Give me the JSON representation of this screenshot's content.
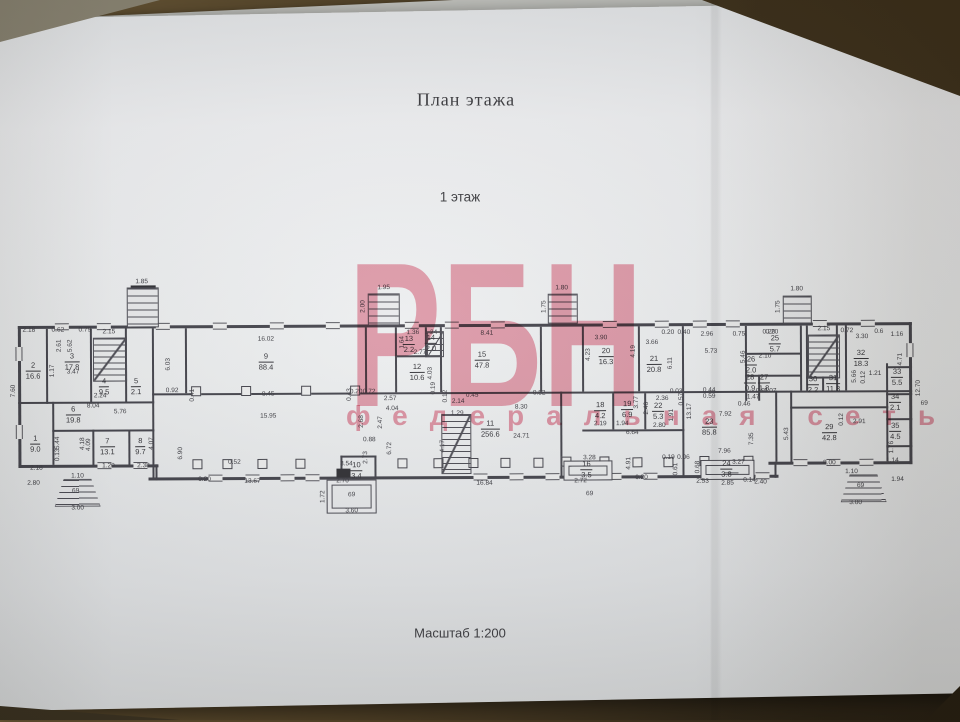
{
  "document": {
    "title": "План этажа",
    "subtitle": "1 этаж",
    "scale_label": "Масштаб 1:200"
  },
  "watermark": {
    "line1": "РБН",
    "line2": "федеральная сеть",
    "color": "#e05672"
  },
  "plan": {
    "rooms": [
      [
        "1",
        "9.0",
        35,
        442
      ],
      [
        "2",
        "16.6",
        33,
        369
      ],
      [
        "3",
        "17.8",
        72,
        360
      ],
      [
        "4",
        "9.5",
        104,
        385
      ],
      [
        "5",
        "2.1",
        136,
        385
      ],
      [
        "6",
        "19.8",
        73,
        413
      ],
      [
        "7",
        "13.1",
        107,
        445
      ],
      [
        "8",
        "9.7",
        140,
        445
      ],
      [
        "9",
        "88.4",
        266,
        361
      ],
      [
        "10",
        "3.4",
        356,
        470
      ],
      [
        "11",
        "256.6",
        490,
        429
      ],
      [
        "12",
        "10.6",
        417,
        372
      ],
      [
        "13",
        "2.2",
        409,
        344
      ],
      [
        "14",
        "2.0",
        431,
        343
      ],
      [
        "15",
        "47.8",
        482,
        360
      ],
      [
        "16",
        "3.5",
        586,
        470
      ],
      [
        "18",
        "4.2",
        600,
        411
      ],
      [
        "19",
        "6.9",
        627,
        410
      ],
      [
        "20",
        "16.3",
        606,
        357
      ],
      [
        "21",
        "20.8",
        654,
        365
      ],
      [
        "22",
        "5.3",
        658,
        412
      ],
      [
        "23",
        "85.8",
        709,
        428
      ],
      [
        "24",
        "3.8",
        726,
        470
      ],
      [
        "25",
        "5.7",
        775,
        345
      ],
      [
        "26",
        "2.0",
        751,
        366
      ],
      [
        "27",
        "1.8",
        764,
        384
      ],
      [
        "28",
        "0.9",
        750,
        384
      ],
      [
        "29",
        "42.8",
        829,
        434
      ],
      [
        "30",
        "2.2",
        813,
        386
      ],
      [
        "31",
        "11.8",
        833,
        385
      ],
      [
        "32",
        "18.3",
        861,
        360
      ],
      [
        "33",
        "5.5",
        897,
        379
      ],
      [
        "34",
        "2.1",
        895,
        404
      ],
      [
        "35",
        "4.5",
        895,
        433
      ]
    ],
    "dims": [
      [
        "2.18",
        29,
        329,
        0
      ],
      [
        "0.62",
        58,
        329,
        0
      ],
      [
        "0.79",
        85,
        329,
        0
      ],
      [
        "2.15",
        109,
        331,
        0
      ],
      [
        "1.85",
        142,
        281,
        0
      ],
      [
        "16.02",
        266,
        339,
        0
      ],
      [
        "1.95",
        384,
        288,
        0
      ],
      [
        "2.00",
        364,
        306,
        1
      ],
      [
        "8.41",
        487,
        334,
        0
      ],
      [
        "1.80",
        562,
        289,
        0
      ],
      [
        "1.75",
        545,
        307,
        1
      ],
      [
        "3.90",
        601,
        339,
        0
      ],
      [
        "0.20",
        668,
        334,
        0
      ],
      [
        "0.40",
        684,
        334,
        0
      ],
      [
        "3.66",
        652,
        344,
        0
      ],
      [
        "2.96",
        707,
        336,
        0
      ],
      [
        "0.75",
        739,
        336,
        0
      ],
      [
        "0.20",
        769,
        334,
        0
      ],
      [
        "2.15",
        824,
        331,
        0
      ],
      [
        "0.72",
        847,
        333,
        0
      ],
      [
        "3.30",
        862,
        339,
        0
      ],
      [
        "0.6",
        879,
        334,
        0
      ],
      [
        "1.16",
        897,
        337,
        0
      ],
      [
        "1.80",
        797,
        291,
        0
      ],
      [
        "1.75",
        779,
        308,
        1
      ],
      [
        "5.62",
        71,
        344,
        1
      ],
      [
        "2.61",
        60,
        344,
        1
      ],
      [
        "1.17",
        53,
        369,
        1
      ],
      [
        "3.47",
        73,
        371,
        0
      ],
      [
        "7.60",
        14,
        389,
        1
      ],
      [
        "6.03",
        169,
        363,
        1
      ],
      [
        "0.92",
        172,
        390,
        0
      ],
      [
        "8.04",
        93,
        405,
        0
      ],
      [
        "5.76",
        120,
        411,
        0
      ],
      [
        "5.44",
        58,
        441,
        1
      ],
      [
        "4.18",
        83,
        442,
        1
      ],
      [
        "4.09",
        89,
        443,
        1
      ],
      [
        "4.07",
        152,
        442,
        1
      ],
      [
        "0.13",
        58,
        453,
        1
      ],
      [
        "1.20",
        108,
        465,
        0
      ],
      [
        "2.38",
        143,
        465,
        0
      ],
      [
        "2.18",
        36,
        467,
        0
      ],
      [
        "2.80",
        33,
        482,
        0
      ],
      [
        "6.90",
        181,
        452,
        1
      ],
      [
        "2.24",
        100,
        395,
        0
      ],
      [
        "0.41",
        193,
        394,
        1
      ],
      [
        "0.45",
        268,
        394,
        0
      ],
      [
        "0.43",
        350,
        394,
        1
      ],
      [
        "0.20",
        356,
        392,
        0
      ],
      [
        "0.72",
        369,
        392,
        0
      ],
      [
        "15.95",
        268,
        416,
        0
      ],
      [
        "0.52",
        234,
        462,
        0
      ],
      [
        "0.20",
        204,
        479,
        0
      ],
      [
        "13.67",
        252,
        481,
        0
      ],
      [
        "3.54",
        346,
        464,
        0
      ],
      [
        "2.70",
        342,
        481,
        0
      ],
      [
        "2.68",
        362,
        421,
        1
      ],
      [
        "2.47",
        381,
        422,
        1
      ],
      [
        "0.88",
        369,
        440,
        0
      ],
      [
        "2.73",
        366,
        457,
        1
      ],
      [
        "1.72",
        323,
        496,
        1
      ],
      [
        "3.60",
        351,
        511,
        0
      ],
      [
        "2.57",
        390,
        399,
        0
      ],
      [
        "4.04",
        392,
        409,
        0
      ],
      [
        "2.14",
        458,
        402,
        0
      ],
      [
        "0.12",
        446,
        396,
        1
      ],
      [
        "0.19",
        434,
        388,
        1
      ],
      [
        "0.45",
        472,
        396,
        0
      ],
      [
        "8.30",
        521,
        408,
        0
      ],
      [
        "0.82",
        539,
        394,
        0
      ],
      [
        "1.29",
        457,
        414,
        0
      ],
      [
        "4.17",
        443,
        446,
        1
      ],
      [
        "6.72",
        390,
        448,
        1
      ],
      [
        "16.84",
        484,
        484,
        0
      ],
      [
        "24.71",
        521,
        437,
        0
      ],
      [
        "2.77",
        420,
        353,
        0
      ],
      [
        "4.03",
        431,
        373,
        1
      ],
      [
        "1.64",
        403,
        342,
        1
      ],
      [
        "1.36",
        413,
        333,
        0
      ],
      [
        "1.24",
        431,
        333,
        0
      ],
      [
        "4.23",
        589,
        355,
        1
      ],
      [
        "4.19",
        634,
        352,
        1
      ],
      [
        "6.11",
        671,
        364,
        1
      ],
      [
        "5.73",
        711,
        353,
        0
      ],
      [
        "5.46",
        744,
        358,
        1
      ],
      [
        "13.17",
        690,
        412,
        1
      ],
      [
        "0.57",
        682,
        400,
        1
      ],
      [
        "2.36",
        662,
        400,
        0
      ],
      [
        "0.03",
        676,
        393,
        0
      ],
      [
        "0.44",
        709,
        392,
        0
      ],
      [
        "0.59",
        709,
        398,
        0
      ],
      [
        "2.19",
        600,
        425,
        0
      ],
      [
        "1.94",
        622,
        425,
        0
      ],
      [
        "2.80",
        659,
        427,
        0
      ],
      [
        "6.64",
        632,
        434,
        0
      ],
      [
        "1.91",
        672,
        416,
        1
      ],
      [
        "7.92",
        725,
        416,
        0
      ],
      [
        "7.96",
        724,
        453,
        0
      ],
      [
        "7.35",
        752,
        440,
        1
      ],
      [
        "4.91",
        629,
        464,
        1
      ],
      [
        "0.19",
        668,
        459,
        0
      ],
      [
        "0.06",
        683,
        459,
        0
      ],
      [
        "0.61",
        676,
        470,
        1
      ],
      [
        "0.68",
        698,
        468,
        1
      ],
      [
        "3.28",
        589,
        459,
        0
      ],
      [
        "2.72",
        580,
        482,
        0
      ],
      [
        "2.53",
        702,
        483,
        0
      ],
      [
        "0.20",
        641,
        479,
        0
      ],
      [
        "3.27",
        738,
        464,
        0
      ],
      [
        "2.85",
        727,
        485,
        0
      ],
      [
        "0.14",
        749,
        482,
        0
      ],
      [
        "2.40",
        760,
        484,
        0
      ],
      [
        "3.77",
        637,
        403,
        1
      ],
      [
        "2.46",
        647,
        409,
        1
      ],
      [
        "0.20",
        772,
        334,
        0
      ],
      [
        "2.10",
        765,
        358,
        0
      ],
      [
        "1.47",
        753,
        399,
        0
      ],
      [
        "0.91",
        762,
        393,
        0
      ],
      [
        "1.07",
        770,
        393,
        0
      ],
      [
        "0.46",
        744,
        406,
        0
      ],
      [
        "5.66",
        855,
        378,
        1
      ],
      [
        "0.12",
        864,
        379,
        1
      ],
      [
        "1.21",
        875,
        376,
        0
      ],
      [
        "4.71",
        901,
        361,
        1
      ],
      [
        "12.70",
        919,
        390,
        1
      ],
      [
        "2.91",
        859,
        424,
        0
      ],
      [
        "0.12",
        842,
        421,
        1
      ],
      [
        "5.43",
        787,
        435,
        1
      ],
      [
        "8.00",
        829,
        465,
        0
      ],
      [
        "1.76",
        892,
        449,
        1
      ],
      [
        "1.14",
        892,
        463,
        0
      ],
      [
        "1.94",
        897,
        482,
        0
      ],
      [
        "1.10",
        851,
        474,
        0
      ],
      [
        "3.00",
        855,
        505,
        0
      ],
      [
        "1.10",
        77,
        475,
        0
      ],
      [
        "3.00",
        77,
        507,
        0
      ],
      [
        "69",
        75,
        490,
        0
      ],
      [
        "69",
        351,
        495,
        0
      ],
      [
        "69",
        589,
        495,
        0
      ],
      [
        "69",
        860,
        488,
        0
      ],
      [
        "69",
        924,
        406,
        0
      ]
    ],
    "walls": [
      [
        18,
        324,
        894,
        3
      ],
      [
        18,
        324,
        3,
        142
      ],
      [
        909,
        324,
        3,
        142
      ],
      [
        18,
        463,
        140,
        3
      ],
      [
        768,
        463,
        144,
        3
      ],
      [
        148,
        476,
        630,
        3
      ],
      [
        155,
        463,
        2,
        16
      ],
      [
        774,
        463,
        2,
        16
      ],
      [
        46,
        327,
        2,
        75
      ],
      [
        90,
        327,
        2,
        75
      ],
      [
        125,
        327,
        2,
        75
      ],
      [
        152,
        327,
        2,
        150
      ],
      [
        185,
        327,
        2,
        65
      ],
      [
        18,
        400,
        136,
        2
      ],
      [
        52,
        400,
        2,
        63
      ],
      [
        52,
        428,
        102,
        2
      ],
      [
        92,
        428,
        2,
        36
      ],
      [
        128,
        428,
        2,
        36
      ],
      [
        152,
        392,
        760,
        2
      ],
      [
        365,
        327,
        2,
        65
      ],
      [
        395,
        327,
        2,
        65
      ],
      [
        425,
        327,
        2,
        30
      ],
      [
        440,
        327,
        2,
        65
      ],
      [
        395,
        355,
        47,
        2
      ],
      [
        540,
        327,
        2,
        65
      ],
      [
        560,
        392,
        2,
        86
      ],
      [
        340,
        455,
        36,
        2
      ],
      [
        340,
        455,
        2,
        22
      ],
      [
        374,
        455,
        2,
        22
      ],
      [
        582,
        327,
        2,
        65
      ],
      [
        638,
        327,
        2,
        65
      ],
      [
        682,
        327,
        2,
        65
      ],
      [
        582,
        430,
        102,
        2
      ],
      [
        612,
        394,
        2,
        36
      ],
      [
        644,
        394,
        2,
        36
      ],
      [
        682,
        392,
        2,
        85
      ],
      [
        745,
        327,
        2,
        75
      ],
      [
        800,
        327,
        2,
        65
      ],
      [
        745,
        354,
        56,
        2
      ],
      [
        745,
        376,
        56,
        2
      ],
      [
        758,
        376,
        2,
        26
      ],
      [
        775,
        392,
        2,
        71
      ],
      [
        790,
        392,
        2,
        73
      ],
      [
        790,
        408,
        98,
        2
      ],
      [
        806,
        327,
        2,
        65
      ],
      [
        836,
        327,
        2,
        65
      ],
      [
        806,
        378,
        32,
        2
      ],
      [
        822,
        378,
        2,
        14
      ],
      [
        845,
        327,
        2,
        65
      ],
      [
        886,
        365,
        2,
        98
      ],
      [
        886,
        368,
        26,
        2
      ],
      [
        886,
        395,
        26,
        2
      ],
      [
        886,
        420,
        26,
        2
      ],
      [
        886,
        447,
        26,
        2
      ]
    ],
    "windows": [
      [
        62,
        325,
        0
      ],
      [
        104,
        325,
        0
      ],
      [
        163,
        325,
        0
      ],
      [
        220,
        325,
        0
      ],
      [
        277,
        325,
        0
      ],
      [
        333,
        325,
        0
      ],
      [
        412,
        325,
        0
      ],
      [
        452,
        325,
        0
      ],
      [
        498,
        325,
        0
      ],
      [
        610,
        325,
        0
      ],
      [
        662,
        325,
        0
      ],
      [
        700,
        325,
        0
      ],
      [
        733,
        325,
        0
      ],
      [
        820,
        325,
        0
      ],
      [
        868,
        325,
        0
      ],
      [
        215,
        477,
        0
      ],
      [
        252,
        477,
        0
      ],
      [
        287,
        477,
        0
      ],
      [
        312,
        477,
        0
      ],
      [
        480,
        477,
        0
      ],
      [
        516,
        477,
        0
      ],
      [
        552,
        477,
        0
      ],
      [
        614,
        477,
        0
      ],
      [
        650,
        477,
        0
      ],
      [
        731,
        477,
        0
      ],
      [
        762,
        477,
        0
      ],
      [
        104,
        464,
        0
      ],
      [
        140,
        464,
        0
      ],
      [
        800,
        464,
        0
      ],
      [
        833,
        464,
        0
      ],
      [
        866,
        464,
        0
      ],
      [
        19,
        352,
        1
      ],
      [
        19,
        430,
        1
      ],
      [
        910,
        352,
        1
      ]
    ],
    "columns": [
      [
        197,
        463
      ],
      [
        227,
        463
      ],
      [
        262,
        463
      ],
      [
        300,
        463
      ],
      [
        402,
        463
      ],
      [
        438,
        463
      ],
      [
        473,
        463
      ],
      [
        505,
        463
      ],
      [
        538,
        463
      ],
      [
        637,
        463
      ],
      [
        668,
        463
      ],
      [
        196,
        390
      ],
      [
        246,
        390
      ],
      [
        306,
        390
      ],
      [
        355,
        390
      ],
      [
        566,
        462
      ],
      [
        604,
        462
      ],
      [
        704,
        462
      ],
      [
        748,
        462
      ]
    ],
    "stairs": [
      [
        93,
        336,
        32,
        42
      ],
      [
        441,
        414,
        28,
        58
      ],
      [
        808,
        336,
        30,
        42
      ],
      [
        427,
        331,
        15,
        24
      ]
    ],
    "porches": [
      {
        "k": "steps",
        "x": 127,
        "y": 286,
        "w": 30,
        "h": 38
      },
      {
        "k": "steps",
        "x": 368,
        "y": 293,
        "w": 30,
        "h": 30
      },
      {
        "k": "steps",
        "x": 548,
        "y": 294,
        "w": 28,
        "h": 28
      },
      {
        "k": "steps",
        "x": 783,
        "y": 297,
        "w": 27,
        "h": 26
      },
      {
        "k": "trap",
        "x": 54,
        "y": 477,
        "w": 44,
        "h": 26
      },
      {
        "k": "trap",
        "x": 840,
        "y": 476,
        "w": 44,
        "h": 26
      },
      {
        "k": "rect",
        "x": 326,
        "y": 479,
        "w": 48,
        "h": 32
      },
      {
        "k": "rect",
        "x": 563,
        "y": 461,
        "w": 47,
        "h": 18
      },
      {
        "k": "rect",
        "x": 700,
        "y": 461,
        "w": 52,
        "h": 18
      }
    ],
    "marks": [
      [
        336,
        468,
        14,
        9
      ],
      [
        131,
        284,
        25,
        8
      ]
    ]
  }
}
